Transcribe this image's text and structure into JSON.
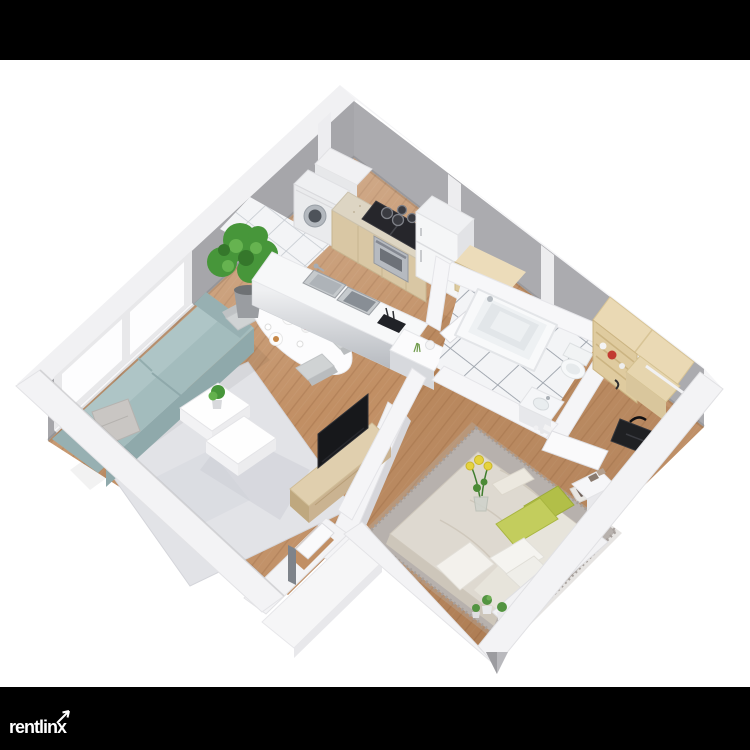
{
  "watermark": {
    "brand": "rentlinx"
  },
  "scene": {
    "kind": "3d-isometric-floor-plan-render",
    "rooms": [
      "living-room",
      "dining-area",
      "kitchen",
      "entry-hall",
      "bathroom",
      "bedroom",
      "walk-in-closet"
    ],
    "furniture": [
      "sofa",
      "throw-pillow",
      "coffee-tables",
      "living-rug",
      "potted-plant",
      "dining-table",
      "dining-chairs",
      "kitchen-island-with-sinks",
      "washing-machine",
      "gas-cooktop",
      "oven",
      "refrigerator",
      "shoe-rack",
      "bathtub",
      "toilet",
      "vanity-sink",
      "double-bed",
      "green-pillows",
      "white-pillows",
      "bedroom-rug",
      "nightstand",
      "flower-vase",
      "tv",
      "tv-stand",
      "wardrobe-shelves",
      "travel-bag",
      "entry-door",
      "entry-landing",
      "windows"
    ]
  },
  "colors": {
    "letterbox": "#000000",
    "background": "#ffffff",
    "wall_left": "#a6a6aa",
    "wall_right": "#ababaf",
    "wall_top": "#f3f3f5",
    "floor_wood": "#c18f64",
    "floor_tile": "#f3f4f6",
    "rug_living": "#e2e3e7",
    "rug_bedroom": "#b7b1ad",
    "sofa_top": "#a3bcbd",
    "sofa_front": "#8fa9ab",
    "pillow_gray": "#c9c6c3",
    "bed": "#ded9d0",
    "pillow_green": "#c3cd5d",
    "plant": "#47963a",
    "flowers_yellow": "#e5d23f",
    "flowers_red": "#ae2f3e",
    "counter": "#ddd5c3",
    "cabinet_wood": "#d9c7a4",
    "shelf_wood": "#ead9b4",
    "stove": "#26262b",
    "tv": "#17181b",
    "bag": "#1f2023",
    "shoes_red": "#c13732",
    "logo_text": "#ffffff"
  }
}
